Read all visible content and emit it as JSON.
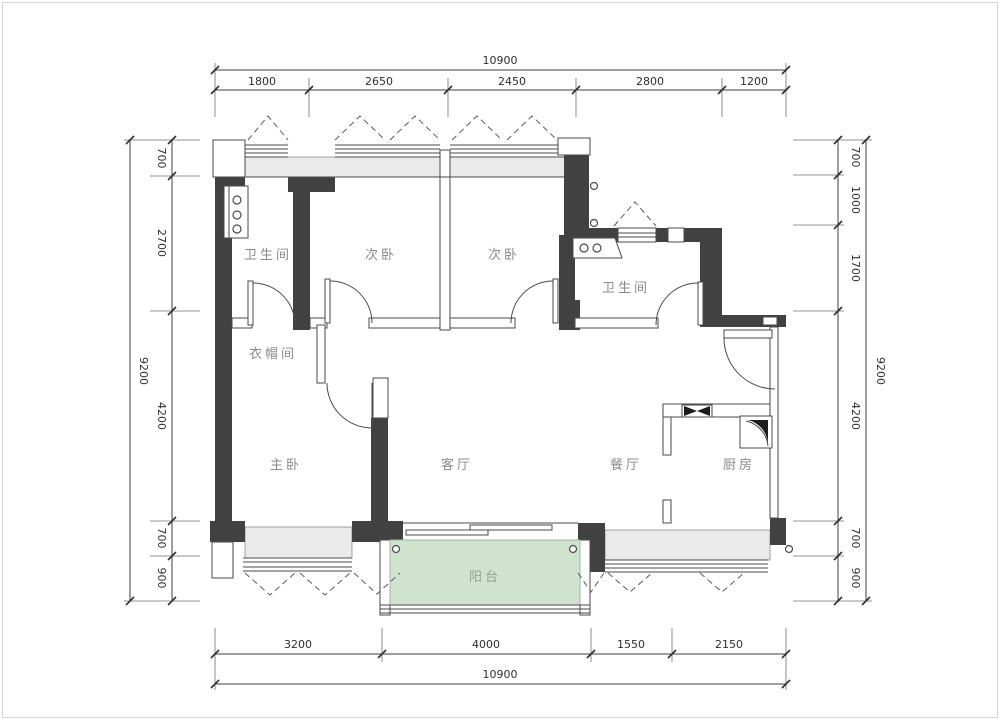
{
  "title": "apartment-floor-plan",
  "rooms": {
    "bath1": "卫生间",
    "bed_a": "次卧",
    "bed_b": "次卧",
    "bath2": "卫生间",
    "cloak": "衣帽间",
    "master": "主卧",
    "living": "客厅",
    "dining": "餐厅",
    "kitchen": "厨房",
    "balcony": "阳台"
  },
  "dims": {
    "top": {
      "total": "10900",
      "segments": [
        "1800",
        "2650",
        "2450",
        "2800",
        "1200"
      ]
    },
    "bottom": {
      "total": "10900",
      "segments": [
        "3200",
        "4000",
        "1550",
        "2150"
      ]
    },
    "left": {
      "total": "9200",
      "segments": [
        "700",
        "2700",
        "4200",
        "700",
        "900"
      ]
    },
    "right": {
      "total": "9200",
      "segments": [
        "700",
        "1000",
        "1700",
        "4200",
        "700",
        "900"
      ]
    }
  },
  "colors": {
    "wall": "#414141",
    "window_band": "#eaeaea",
    "balcony_fill": "#cfe3cf",
    "balcony_text": "#8fa794",
    "room_text": "#8a8a8a",
    "dim_text": "#2f2f2f"
  }
}
